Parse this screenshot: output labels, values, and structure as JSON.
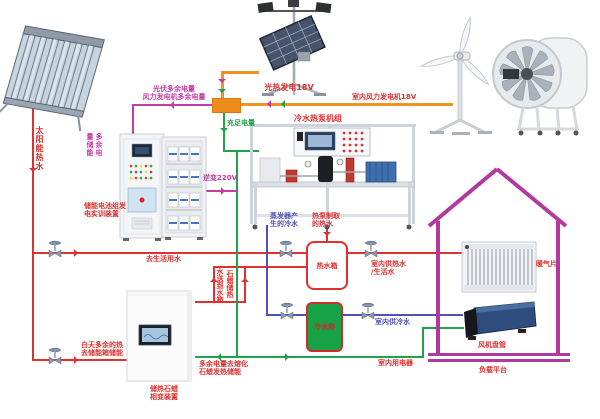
{
  "colors": {
    "hot_water_pipe": "#e03030",
    "cold_water_pipe": "#5151bb",
    "sufficient_power_wire": "#1ea24a",
    "generation_wire": "#ef9421",
    "surplus_power_wire": "#c43ba6",
    "house_outline": "#b23a9e",
    "cold_tank_fill": "#17a345",
    "junction_box": "#ef8b1d"
  },
  "labels": {
    "solar_hot_water": "太阳能热水",
    "pv_generation": "光热发电18V",
    "wind_generation": "室内风力发电机18V",
    "surplus_pv": "光伏多余电量",
    "surplus_wind": "风力发电机多余电量",
    "sufficient_power": "充足电量",
    "surplus_storage": "多余电量储能",
    "inverter": "逆变220V",
    "battery_device": "储能电池组发\n电实训装置",
    "heat_pump_unit": "冷水热泵机组",
    "evaporator_cold": "蒸发器产\n生的冷水",
    "heat_pump_hot": "热泵制取\n的热水",
    "hot_tank": "热水箱",
    "cold_tank": "冷水箱",
    "to_domestic_water": "去生活用水",
    "indoor_hot_water": "室内供热水\n/生活水",
    "indoor_cold_water": "室内供冷水",
    "indoor_appliances": "室内用电器",
    "melt_paraffin": "多余电量去熔化\n石蜡发热储能",
    "day_surplus_heat": "白天多余的热\n去储能箱储能",
    "paraffin_device": "储热石蜡\n相变装置",
    "paraffin_flow_right": "石蜡储热",
    "paraffin_flow_left": "水送到水箱",
    "radiator": "暖气片",
    "fan_coil": "风机盘管",
    "load_platform": "负载平台"
  }
}
